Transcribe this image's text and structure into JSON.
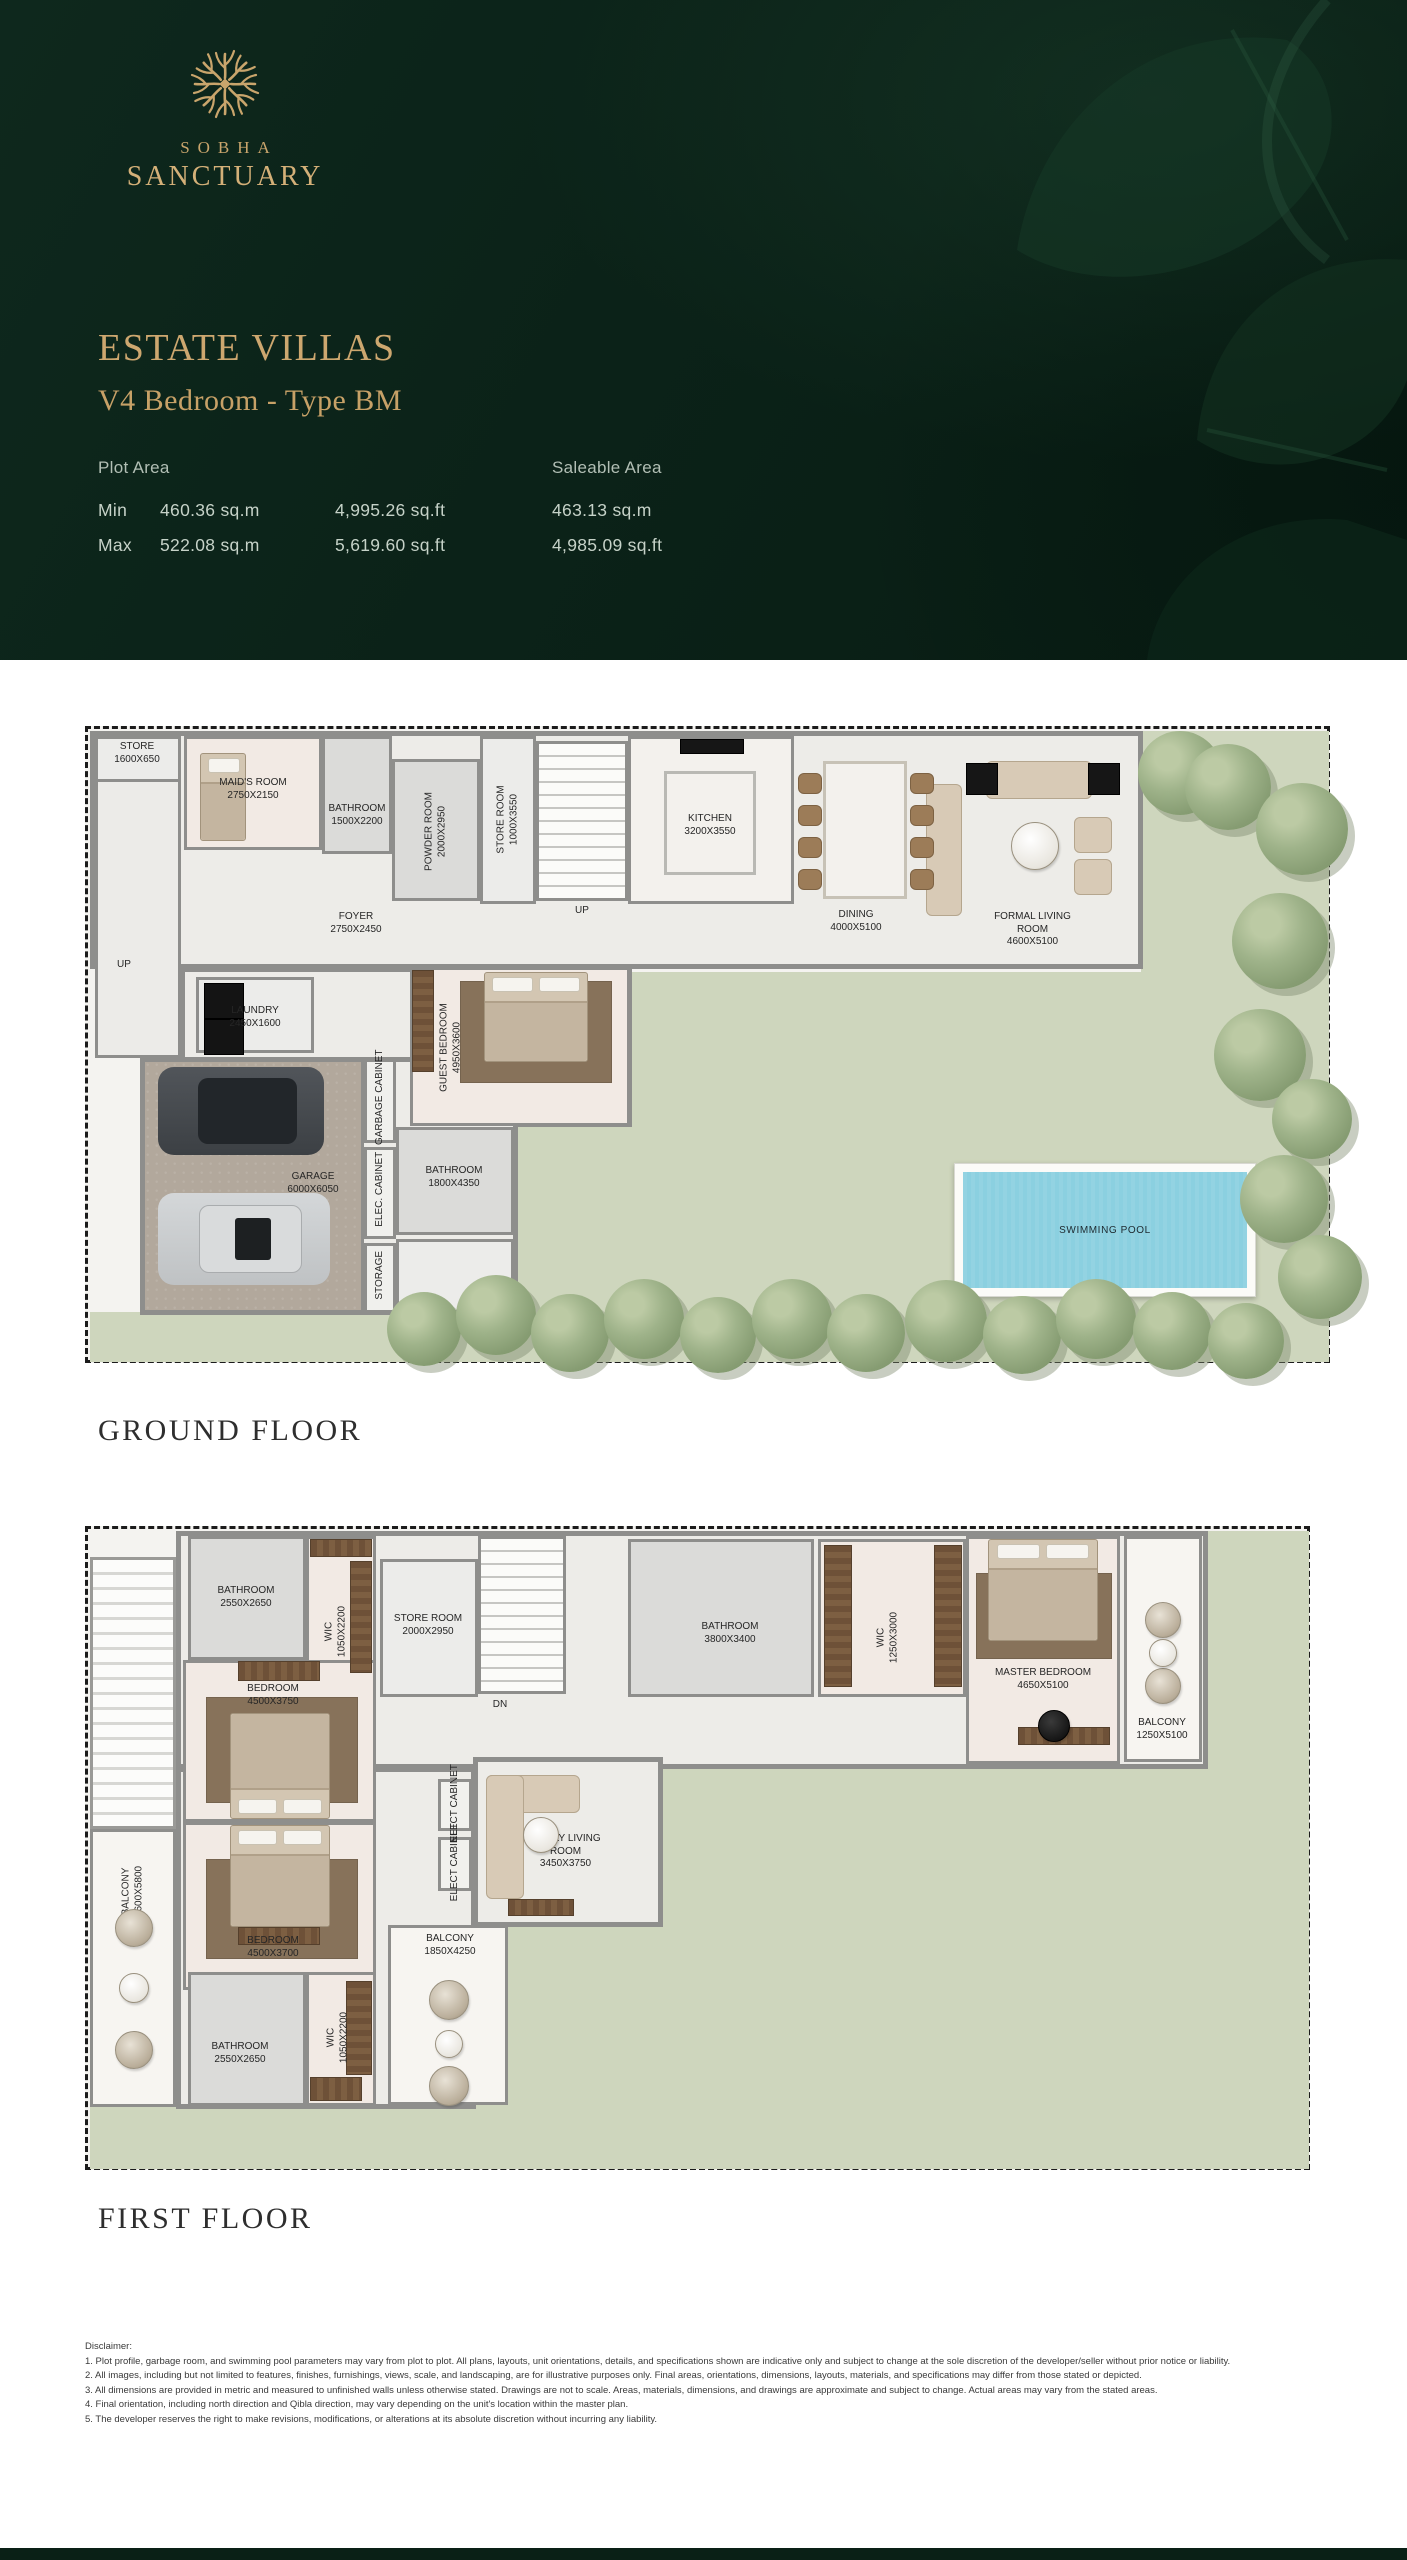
{
  "brand": {
    "logo_icon": "branch-tree-icon",
    "name_line1": "SOBHA",
    "name_line2": "SANCTUARY"
  },
  "header": {
    "title": "ESTATE VILLAS",
    "subtitle": "V4 Bedroom - Type BM",
    "plot_area": {
      "label": "Plot Area",
      "rows": [
        {
          "label": "Min",
          "sqm": "460.36 sq.m",
          "sqft": "4,995.26 sq.ft"
        },
        {
          "label": "Max",
          "sqm": "522.08 sq.m",
          "sqft": "5,619.60 sq.ft"
        }
      ]
    },
    "saleable_area": {
      "label": "Saleable Area",
      "sqm": "463.13 sq.m",
      "sqft": "4,985.09 sq.ft"
    }
  },
  "floors": {
    "ground": {
      "label": "GROUND FLOOR",
      "rooms": {
        "store": {
          "name": "STORE",
          "dims": "1600X650"
        },
        "maids": {
          "name": "MAID'S ROOM",
          "dims": "2750X2150"
        },
        "bath1": {
          "name": "BATHROOM",
          "dims": "1500X2200"
        },
        "powder": {
          "name": "POWDER ROOM",
          "dims": "2000X2950"
        },
        "storeroom": {
          "name": "STORE ROOM",
          "dims": "1000X3550"
        },
        "foyer": {
          "name": "FOYER",
          "dims": "2750X2450"
        },
        "kitchen": {
          "name": "KITCHEN",
          "dims": "3200X3550"
        },
        "dining": {
          "name": "DINING",
          "dims": "4000X5100"
        },
        "formal": {
          "name": "FORMAL LIVING ROOM",
          "dims": "4600X5100"
        },
        "laundry": {
          "name": "LAUNDRY",
          "dims": "2450X1600"
        },
        "guest": {
          "name": "GUEST BEDROOM",
          "dims": "4950X3600"
        },
        "garbage": {
          "name": "GARBAGE CABINET"
        },
        "garage": {
          "name": "GARAGE",
          "dims": "6000X6050"
        },
        "elec": {
          "name": "ELEC. CABINET"
        },
        "bath2": {
          "name": "BATHROOM",
          "dims": "1800X4350"
        },
        "storage": {
          "name": "STORAGE"
        },
        "pool": {
          "name": "SWIMMING POOL"
        },
        "up1": {
          "name": "UP"
        },
        "up2": {
          "name": "UP"
        }
      }
    },
    "first": {
      "label": "FIRST FLOOR",
      "rooms": {
        "bath1": {
          "name": "BATHROOM",
          "dims": "2550X2650"
        },
        "wic1": {
          "name": "WIC",
          "dims": "1050X2200"
        },
        "storeroom": {
          "name": "STORE ROOM",
          "dims": "2000X2950"
        },
        "bed1": {
          "name": "BEDROOM",
          "dims": "4500X3750"
        },
        "dn": {
          "name": "DN"
        },
        "bath2": {
          "name": "BATHROOM",
          "dims": "3800X3400"
        },
        "wic2": {
          "name": "WIC",
          "dims": "1250X3000"
        },
        "master": {
          "name": "MASTER BEDROOM",
          "dims": "4650X5100"
        },
        "balc1": {
          "name": "BALCONY",
          "dims": "1250X5100"
        },
        "balc2": {
          "name": "BALCONY",
          "dims": "1600X5800"
        },
        "bed2": {
          "name": "BEDROOM",
          "dims": "4500X3700"
        },
        "bath3": {
          "name": "BATHROOM",
          "dims": "2550X2650"
        },
        "wic3": {
          "name": "WIC",
          "dims": "1050X2200"
        },
        "balc3": {
          "name": "BALCONY",
          "dims": "1850X4250"
        },
        "family": {
          "name": "FAMILY LIVING ROOM",
          "dims": "3450X3750"
        },
        "elect1": {
          "name": "ELECT CABINET"
        },
        "elect2": {
          "name": "ELECT CABINET"
        }
      }
    }
  },
  "disclaimer": {
    "title": "Disclaimer:",
    "items": [
      "1. Plot profile, garbage room, and swimming pool parameters may vary from plot to plot. All plans, layouts, unit orientations, details, and specifications shown are indicative only and subject to change at the sole discretion of the developer/seller without prior notice or liability.",
      "2. All images, including but not limited to features, finishes, furnishings, views, scale, and landscaping, are for illustrative purposes only. Final areas, orientations, dimensions, layouts, materials, and specifications may differ from those stated or depicted.",
      "3. All dimensions are provided in metric and measured to unfinished walls unless otherwise stated. Drawings are not to scale. Areas, materials, dimensions, and drawings are approximate and subject to change. Actual areas may vary from the stated areas.",
      "4. Final orientation, including north direction and Qibla direction, may vary depending on the unit's location within the master plan.",
      "5. The developer reserves the right to make revisions, modifications, or alterations at its absolute discretion without incurring any liability."
    ]
  },
  "colors": {
    "header_bg": "#0b2218",
    "gold": "#c9a56c",
    "garden": "#ced6bd",
    "pool": "#8bd0e0",
    "wall": "#8e8e8c"
  }
}
